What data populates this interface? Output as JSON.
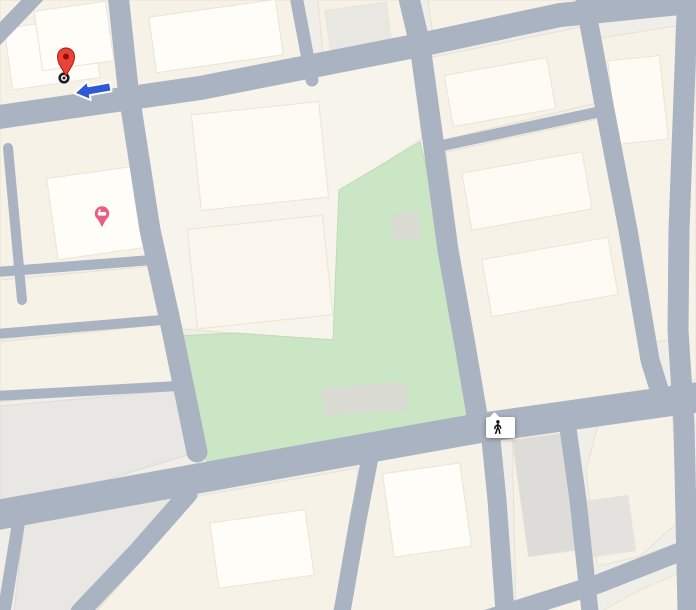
{
  "colors": {
    "land": "#f0eee8",
    "block": "#f7f2e8",
    "block_gray": "#e8e7e3",
    "road": "#aab3c1",
    "park": "#cbe6c4",
    "park_label": "#5d9c61",
    "route": "#1e6ae1",
    "route_border": "#174ea6",
    "connector": "#9fc0f5",
    "destination_red": "#ea4335",
    "hotel_pink": "#e85f83",
    "transit_blue": "#4d7fe3",
    "arrow_blue": "#2b59d8",
    "building_label": "#5e6267",
    "road_label": "#f7f9fb"
  },
  "destination": {
    "label": "bby Shop"
  },
  "tooltip": {
    "duration": "5 min",
    "distance": "350m"
  },
  "road_labels": {
    "bute": "Bute St",
    "canton": "Canton Rd",
    "shanghai": "Shanghai St",
    "mong_kok": "Mong Kok Rd",
    "fife": "Fife St",
    "rd_fragment": "Rd"
  },
  "places": {
    "jordache": {
      "lines": [
        "Jordache",
        "Industrial Building",
        "名駒工業樓"
      ]
    },
    "bute_wah": {
      "lines": [
        "Bute Wah Mansion",
        "弼華大廈"
      ]
    },
    "lee_fat": {
      "lines": [
        "Lee Fat Building",
        "利發大廈"
      ]
    },
    "hing_fat": {
      "lines": [
        "Hing Fat Building",
        "興發樓"
      ]
    },
    "hip_wo": {
      "lines": [
        "Hip Wo Industrial",
        "Building",
        "協和工業大廈"
      ]
    },
    "hang_tung": {
      "lines": [
        "Hang Tung",
        "Building Podium",
        "恆通大廈平台"
      ]
    },
    "fu_wah": {
      "lines": [
        "Fu Wah Building",
        "富華大樓"
      ]
    },
    "shanghai_building": {
      "lines": [
        "Shanghai Building",
        "上海大廈"
      ]
    },
    "canton_plaza": {
      "lines": [
        "Canton Plaza",
        "廣建中心"
      ]
    },
    "kwong_wing": {
      "lines": [
        "Kwong Wing Building",
        "光榮大樓"
      ]
    },
    "fuk_on": {
      "lines": [
        "Fuk On Factory Building",
        "福安工廠大廈"
      ]
    },
    "kam_kee": {
      "lines": [
        "Kam Kee House",
        "金基樓"
      ]
    },
    "playground": {
      "lines": [
        "Mong",
        "Kok Road",
        "Playground",
        "旺角道遊樂場"
      ]
    },
    "bright_way": {
      "lines": [
        "Bright Way Tower",
        "凱迪發展大廈"
      ]
    },
    "cheong_fu": {
      "lines": [
        "Cheong Fu Mansion",
        "昌富大廈"
      ]
    },
    "yuet_yuen": {
      "lines": [
        "Yuet Yuen Building",
        "月園大廈"
      ]
    },
    "garfull": {
      "lines": [
        "Garfull Building",
        "嘉富大廈"
      ]
    },
    "centre_partial": {
      "lines": [
        "ury Centre",
        "中心"
      ]
    },
    "house_partial": {
      "lines": [
        "itax House"
      ]
    }
  },
  "route": {
    "dots": [
      [
        120,
        90
      ],
      [
        125,
        117
      ],
      [
        130,
        144
      ],
      [
        136,
        171
      ],
      [
        141,
        197
      ],
      [
        146,
        223
      ],
      [
        151,
        249
      ],
      [
        156,
        276
      ],
      [
        162,
        303
      ],
      [
        167,
        330
      ],
      [
        172,
        357
      ],
      [
        177,
        383
      ],
      [
        252,
        452
      ],
      [
        279,
        449
      ],
      [
        307,
        446
      ],
      [
        335,
        442
      ],
      [
        362,
        436
      ],
      [
        390,
        431
      ],
      [
        417,
        424
      ],
      [
        446,
        418
      ],
      [
        473,
        413
      ],
      [
        500,
        408
      ],
      [
        527,
        404
      ],
      [
        556,
        401
      ],
      [
        583,
        397
      ],
      [
        689,
        459
      ],
      [
        690,
        486
      ],
      [
        691,
        513
      ]
    ],
    "solid_segments": [
      "M 181,397 Q 192,442 197,452 Q 202,459 232,457",
      "M 598,396 C 618,390 632,384 641,386 C 655,388 659,396 663,404 C 673,412 685,416 688,432",
      "M 690,500 C 692,520 693,560 694,612"
    ],
    "connector": "M 76,67 L 112,62 L 119,80",
    "turn_points": [
      [
        198,
        461
      ],
      [
        682,
        397
      ]
    ]
  },
  "map_icons": {
    "traffic_lights": [
      [
        416,
        44
      ],
      [
        352,
        448
      ],
      [
        484,
        425
      ],
      [
        638,
        391
      ],
      [
        661,
        386
      ]
    ],
    "bus_stops": [
      [
        121,
        475
      ],
      [
        150,
        460
      ],
      [
        609,
        372
      ],
      [
        361,
        589
      ]
    ],
    "one_way_arrows": [
      [
        123,
        33,
        -96
      ],
      [
        258,
        76,
        -10
      ],
      [
        576,
        6,
        -12
      ],
      [
        447,
        429,
        -10
      ],
      [
        575,
        436,
        82
      ],
      [
        643,
        295,
        80
      ],
      [
        587,
        505,
        83
      ],
      [
        13,
        556,
        -95
      ]
    ]
  },
  "icon_shapes": {
    "destination-pin-icon": "red teardrop pin",
    "destination-dot-icon": "bullseye circle",
    "direction-arrow-icon": "bold blue left arrow",
    "walking-icon": "pedestrian stick figure",
    "bus-stop-icon": "blue square with bus",
    "traffic-light-icon": "signal with red amber green",
    "hotel-icon": "pink lodging pin",
    "one-way-arrow-icon": "gray road arrow",
    "turn-point-icon": "white maneuver circle"
  }
}
